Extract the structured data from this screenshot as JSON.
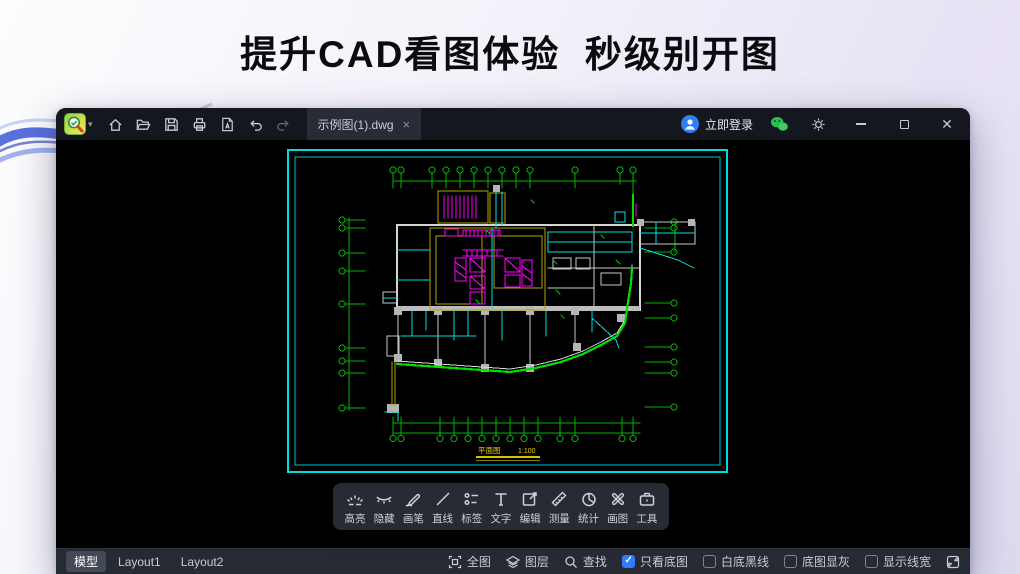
{
  "page": {
    "headline": "提升CAD看图体验  秒级别开图"
  },
  "titlebar": {
    "tab": "示例图(1).dwg",
    "login": "立即登录",
    "tool_icons": [
      "home-icon",
      "open-folder-icon",
      "save-icon",
      "print-icon",
      "pdf-export-icon",
      "undo-icon",
      "redo-icon"
    ],
    "right_icons": [
      "avatar-icon",
      "wechat-icon",
      "gear-icon",
      "minimize-icon",
      "maximize-icon",
      "close-icon"
    ]
  },
  "float_toolbar": {
    "items": [
      {
        "label": "高亮",
        "icon": "highlight-icon"
      },
      {
        "label": "隐藏",
        "icon": "hide-eye-icon"
      },
      {
        "label": "画笔",
        "icon": "pen-icon"
      },
      {
        "label": "直线",
        "icon": "line-icon"
      },
      {
        "label": "标签",
        "icon": "tag-list-icon"
      },
      {
        "label": "文字",
        "icon": "text-icon"
      },
      {
        "label": "编辑",
        "icon": "edit-icon"
      },
      {
        "label": "测量",
        "icon": "measure-icon"
      },
      {
        "label": "统计",
        "icon": "stats-pie-icon"
      },
      {
        "label": "画图",
        "icon": "draw-cross-icon"
      },
      {
        "label": "工具",
        "icon": "toolbox-icon"
      }
    ]
  },
  "statusbar": {
    "tabs": [
      {
        "label": "模型",
        "active": true
      },
      {
        "label": "Layout1",
        "active": false
      },
      {
        "label": "Layout2",
        "active": false
      }
    ],
    "buttons": [
      {
        "label": "全图",
        "icon": "fit-view-icon"
      },
      {
        "label": "图层",
        "icon": "layers-icon"
      },
      {
        "label": "查找",
        "icon": "search-icon"
      }
    ],
    "toggles": [
      {
        "label": "只看底图",
        "checked": true
      },
      {
        "label": "白底黑线",
        "checked": false
      },
      {
        "label": "底图显灰",
        "checked": false
      },
      {
        "label": "显示线宽",
        "checked": false
      }
    ],
    "expand_icon": "fullscreen-expand-icon"
  },
  "drawing": {
    "caption": "平面图",
    "scale": "1:100"
  },
  "colors": {
    "accent_blue": "#2F7EF7",
    "wechat_green": "#2BBB4F",
    "frame_teal": "#00DCDC",
    "axis_green": "#00B400",
    "boundary_green": "#00E000",
    "wall_gray": "#D5D5D5",
    "core_yellow": "#B2A300",
    "elevator_magenta": "#FF00FF",
    "pipe_cyan": "#00E0E0",
    "caption_yellow": "#E6D000",
    "titlebar_bg": "#14171E",
    "statusbar_bg": "#262A33",
    "toolbar_bg": "#272B34"
  }
}
